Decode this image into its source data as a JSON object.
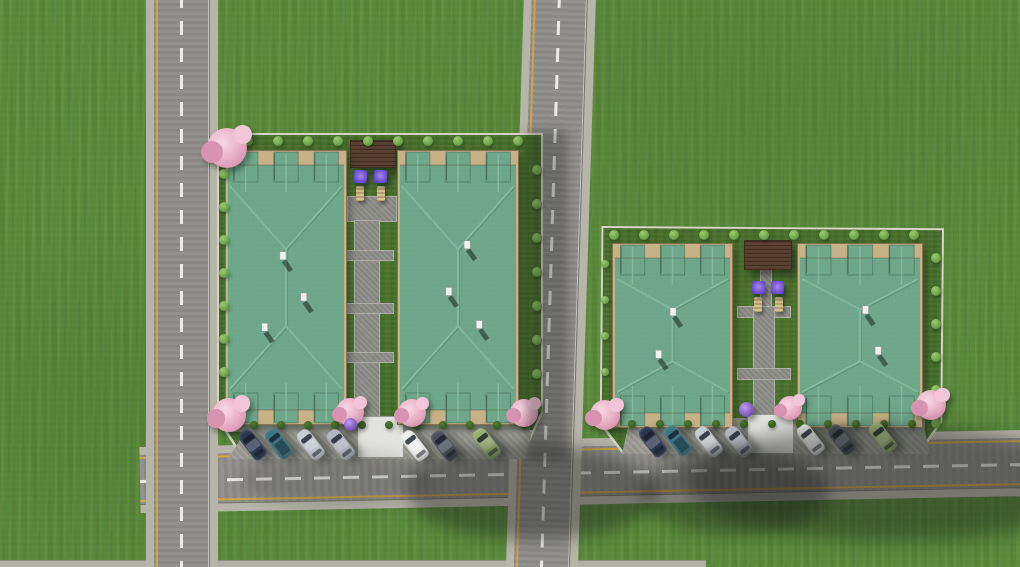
{
  "scene": {
    "description": "Aerial 3D architectural render: two residential complexes with green hip roofs, landscaped lots, two vertical roads, one horizontal road with angled parked cars, cherry trees and purple patio umbrellas",
    "canvas": {
      "width": 1020,
      "height": 567
    },
    "counts": {
      "buildings": 4,
      "cars": 14,
      "lots": 2,
      "roads": 3
    },
    "colors": {
      "grass": "#58883a",
      "lot_grass": "#476f2b",
      "road_asphalt": "#8f8e8a",
      "sidewalk": "#b7b4aa",
      "curb_line": "#77766f",
      "lane_yellow": "#d4a840",
      "lane_white": "#eceae6",
      "roof_green": "#6fa78b",
      "roof_ridge_light": "#8fc2a6",
      "roof_ridge_dark": "#4c8066",
      "terrace_tan": "#c8b187",
      "lot_wall": "#d8d4c6",
      "path_gray": "#8d8d87",
      "parking_gray": "#9e9e97",
      "walkway_white": "#e2e2de",
      "pergola_brown": "#5a4030",
      "umbrella_purple": "#7050d4",
      "tree_pink": "#eab3c8",
      "tree_pink_dark": "#d893b0",
      "tree_purple": "#8a63c8",
      "bush_light": "#79ad52",
      "bush_dark": "#3c6423",
      "chimney_white": "#f2f2ee",
      "shadow": "22,26,22",
      "bottom_strip": "#b3b1a7"
    }
  },
  "roads": {
    "vertical_left": {
      "x": 146,
      "width": 72,
      "yellow_left": true,
      "dashed_center": true
    },
    "vertical_middle": {
      "x": 524,
      "width": 72,
      "tilt_deg": 1.8,
      "yellow_left": true,
      "dashed_center": true
    },
    "horizontal_bottom": {
      "x": 140,
      "y": 447,
      "length": 900,
      "height": 66,
      "tilt_deg": -1.1,
      "yellow_both_edges": true,
      "dashed_center": true
    },
    "bottom_edge_strip": {
      "x": 0,
      "y": 560,
      "width": 706,
      "height": 7
    }
  },
  "lots": [
    {
      "id": "left",
      "bush_rows": [
        {
          "x": 248,
          "y": 141,
          "dx": 30,
          "dy": 0,
          "n": 10,
          "r": 5,
          "tone": "light"
        },
        {
          "x": 224,
          "y": 174,
          "dx": 0,
          "dy": 33,
          "n": 8,
          "r": 5,
          "tone": "light"
        },
        {
          "x": 537,
          "y": 170,
          "dx": 0,
          "dy": 34,
          "n": 8,
          "r": 5,
          "tone": "light"
        },
        {
          "x": 254,
          "y": 425,
          "dx": 27,
          "dy": 0,
          "n": 11,
          "r": 4,
          "tone": "dark"
        }
      ],
      "paths": [
        [
          347,
          196,
          50,
          26
        ],
        [
          354,
          220,
          26,
          206
        ],
        [
          340,
          250,
          54,
          11
        ],
        [
          340,
          303,
          54,
          11
        ],
        [
          340,
          352,
          54,
          11
        ]
      ],
      "apron": [
        230,
        421,
        300,
        11
      ],
      "pergola": [
        350,
        140,
        44,
        26
      ],
      "umbrellas": [
        [
          354,
          170
        ],
        [
          374,
          170
        ]
      ],
      "loungers": [
        [
          356,
          186
        ],
        [
          377,
          186
        ]
      ],
      "walkway": [
        357,
        416,
        45,
        40
      ],
      "parking": {
        "x": 228,
        "y": 430,
        "w": 304,
        "h": 27,
        "clip": "polygon(6% 0%, 100% 0%, 98% 100%, 0% 100%)"
      }
    },
    {
      "id": "right",
      "bush_rows": [
        {
          "x": 614,
          "y": 235,
          "dx": 30,
          "dy": 0,
          "n": 11,
          "r": 5,
          "tone": "light"
        },
        {
          "x": 605,
          "y": 264,
          "dx": 0,
          "dy": 36,
          "n": 5,
          "r": 4,
          "tone": "light"
        },
        {
          "x": 936,
          "y": 258,
          "dx": 0,
          "dy": 33,
          "n": 6,
          "r": 5,
          "tone": "light"
        },
        {
          "x": 632,
          "y": 424,
          "dx": 28,
          "dy": 0,
          "n": 11,
          "r": 4,
          "tone": "dark"
        }
      ],
      "paths": [
        [
          760,
          268,
          12,
          42
        ],
        [
          737,
          306,
          54,
          12
        ],
        [
          753,
          306,
          22,
          122
        ],
        [
          737,
          368,
          54,
          12
        ]
      ],
      "apron": [
        625,
        418,
        300,
        10
      ],
      "pergola": [
        744,
        240,
        46,
        28
      ],
      "umbrellas": [
        [
          752,
          281
        ],
        [
          771,
          281
        ]
      ],
      "loungers": [
        [
          754,
          297
        ],
        [
          775,
          297
        ]
      ],
      "walkway": [
        747,
        414,
        45,
        38
      ],
      "parking": {
        "x": 622,
        "y": 426,
        "w": 308,
        "h": 26,
        "clip": "polygon(2% 0%, 98% 0%, 100% 100%, 0% 100%)"
      }
    }
  ],
  "buildings": [
    {
      "x": 225,
      "y": 150,
      "w": 122,
      "h": 275,
      "chimneys": [
        [
          0.45,
          0.37
        ],
        [
          0.62,
          0.52
        ],
        [
          0.3,
          0.63
        ]
      ]
    },
    {
      "x": 397,
      "y": 150,
      "w": 122,
      "h": 275,
      "chimneys": [
        [
          0.55,
          0.33
        ],
        [
          0.4,
          0.5
        ],
        [
          0.65,
          0.62
        ]
      ]
    },
    {
      "x": 612,
      "y": 243,
      "w": 121,
      "h": 185,
      "chimneys": [
        [
          0.48,
          0.35
        ],
        [
          0.36,
          0.58
        ]
      ]
    },
    {
      "x": 797,
      "y": 243,
      "w": 126,
      "h": 185,
      "chimneys": [
        [
          0.52,
          0.34
        ],
        [
          0.62,
          0.56
        ]
      ]
    }
  ],
  "trees": [
    {
      "x": 207,
      "y": 128,
      "s": 40,
      "kind": "pink"
    },
    {
      "x": 212,
      "y": 398,
      "s": 34,
      "kind": "pink"
    },
    {
      "x": 336,
      "y": 398,
      "s": 28,
      "kind": "pink"
    },
    {
      "x": 398,
      "y": 399,
      "s": 28,
      "kind": "pink"
    },
    {
      "x": 510,
      "y": 399,
      "s": 28,
      "kind": "pink"
    },
    {
      "x": 344,
      "y": 418,
      "s": 13,
      "kind": "purple"
    },
    {
      "x": 739,
      "y": 402,
      "s": 15,
      "kind": "purple"
    },
    {
      "x": 778,
      "y": 396,
      "s": 24,
      "kind": "pink"
    },
    {
      "x": 590,
      "y": 400,
      "s": 30,
      "kind": "pink"
    },
    {
      "x": 916,
      "y": 390,
      "s": 30,
      "kind": "pink"
    }
  ],
  "cars": [
    {
      "x": 252,
      "y": 444,
      "color": "#2b3650",
      "type": "sedan"
    },
    {
      "x": 278,
      "y": 443,
      "color": "#3b7487",
      "type": "pickup"
    },
    {
      "x": 310,
      "y": 444,
      "color": "#c7ccd3",
      "type": "sedan"
    },
    {
      "x": 340,
      "y": 444,
      "color": "#b3b9c1",
      "type": "sedan"
    },
    {
      "x": 414,
      "y": 445,
      "color": "#eeeeec",
      "type": "sedan"
    },
    {
      "x": 444,
      "y": 445,
      "color": "#4a505a",
      "type": "sedan"
    },
    {
      "x": 486,
      "y": 443,
      "color": "#9fb574",
      "type": "sedan"
    },
    {
      "x": 652,
      "y": 441,
      "color": "#2b3650",
      "type": "sedan"
    },
    {
      "x": 677,
      "y": 440,
      "color": "#3b7487",
      "type": "pickup"
    },
    {
      "x": 708,
      "y": 441,
      "color": "#c7ccd3",
      "type": "sedan"
    },
    {
      "x": 738,
      "y": 441,
      "color": "#b3b9c1",
      "type": "sedan"
    },
    {
      "x": 810,
      "y": 439,
      "color": "#eeeeec",
      "type": "sedan"
    },
    {
      "x": 841,
      "y": 439,
      "color": "#4a505a",
      "type": "sedan"
    },
    {
      "x": 882,
      "y": 437,
      "color": "#9fb574",
      "type": "sedan"
    }
  ],
  "shadows": [
    {
      "x": 526,
      "y": 130,
      "w": 42,
      "h": 330,
      "blur": 5,
      "radius": "8px",
      "alpha": 0.75
    },
    {
      "x": 240,
      "y": 452,
      "w": 190,
      "h": 56,
      "blur": 8,
      "radius": "50%",
      "alpha": 0.45
    },
    {
      "x": 408,
      "y": 444,
      "w": 250,
      "h": 95,
      "blur": 8,
      "radius": "45% 55% 50% 50%",
      "alpha": 1
    },
    {
      "x": 640,
      "y": 450,
      "w": 190,
      "h": 85,
      "blur": 8,
      "radius": "50%",
      "alpha": 0.9
    },
    {
      "x": 686,
      "y": 426,
      "w": 395,
      "h": 115,
      "blur": 9,
      "radius": "50% 50% 45% 55%",
      "alpha": 1
    }
  ]
}
